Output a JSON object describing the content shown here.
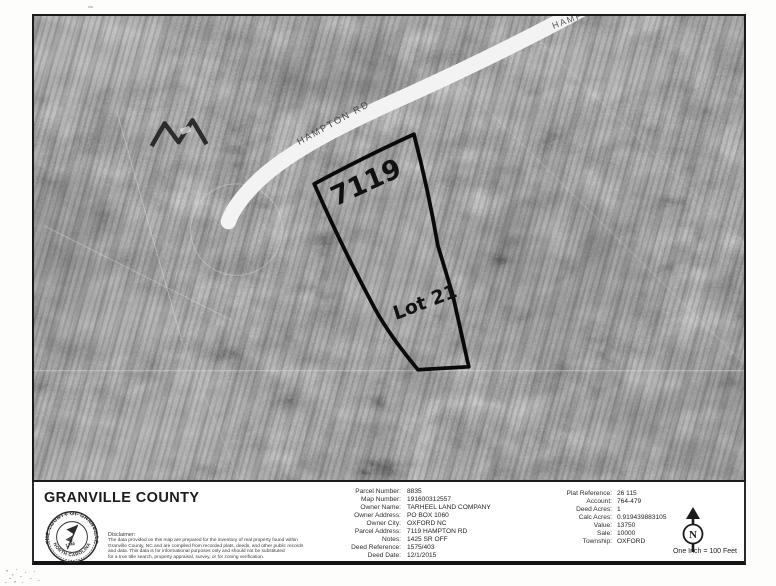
{
  "map": {
    "road_label": "HAMPTON RD",
    "road_label_partial": "HAMPTO",
    "parcel_number_label": "7119",
    "lot_label": "Lot 21",
    "colors": {
      "photo_base": "#949494",
      "road": "#f3f3f3",
      "parcel_outline": "#0a0a0a"
    }
  },
  "footer": {
    "county_title": "GRANVILLE COUNTY",
    "seal": {
      "ring_top": "THE COUNTY OF GRANVILLE",
      "ring_bottom": "NORTH CAROLINA",
      "year": "1746"
    },
    "disclaimer_title": "Disclaimer:",
    "disclaimer_lines": [
      "The data provided on this map are prepared for the inventory of real property found within",
      "Granville County, NC and are compiled from recorded plats, deeds, and other public records",
      "and data.  This data is for informational purposes only and should not be substituted",
      "for a true title search, property appraisal, survey, or for zoning verification."
    ],
    "parcel_info": [
      {
        "label": "Parcel Number:",
        "value": "8835"
      },
      {
        "label": "Map Number:",
        "value": "191600312557"
      },
      {
        "label": "Owner Name:",
        "value": "TARHEEL LAND COMPANY"
      },
      {
        "label": "Owner Address:",
        "value": "PO BOX 1060"
      },
      {
        "label": "Owner City:",
        "value": "OXFORD NC"
      },
      {
        "label": "Parcel Address:",
        "value": "7119 HAMPTON RD"
      },
      {
        "label": "Notes:",
        "value": "1425 SR OFF"
      },
      {
        "label": "Deed Reference:",
        "value": "1575/403"
      },
      {
        "label": "Deed Date:",
        "value": "12/1/2015"
      }
    ],
    "plat_info": [
      {
        "label": "Plat Reference:",
        "value": "26 115"
      },
      {
        "label": "Account:",
        "value": "764-479"
      },
      {
        "label": "Deed Acres:",
        "value": "1"
      },
      {
        "label": "Calc Acres:",
        "value": "0.919439883105"
      },
      {
        "label": "Value:",
        "value": "13750"
      },
      {
        "label": "Sale:",
        "value": "10000"
      },
      {
        "label": "Township:",
        "value": "OXFORD"
      }
    ],
    "north_label": "N",
    "scale_text": "One Inch = 100 Feet"
  }
}
